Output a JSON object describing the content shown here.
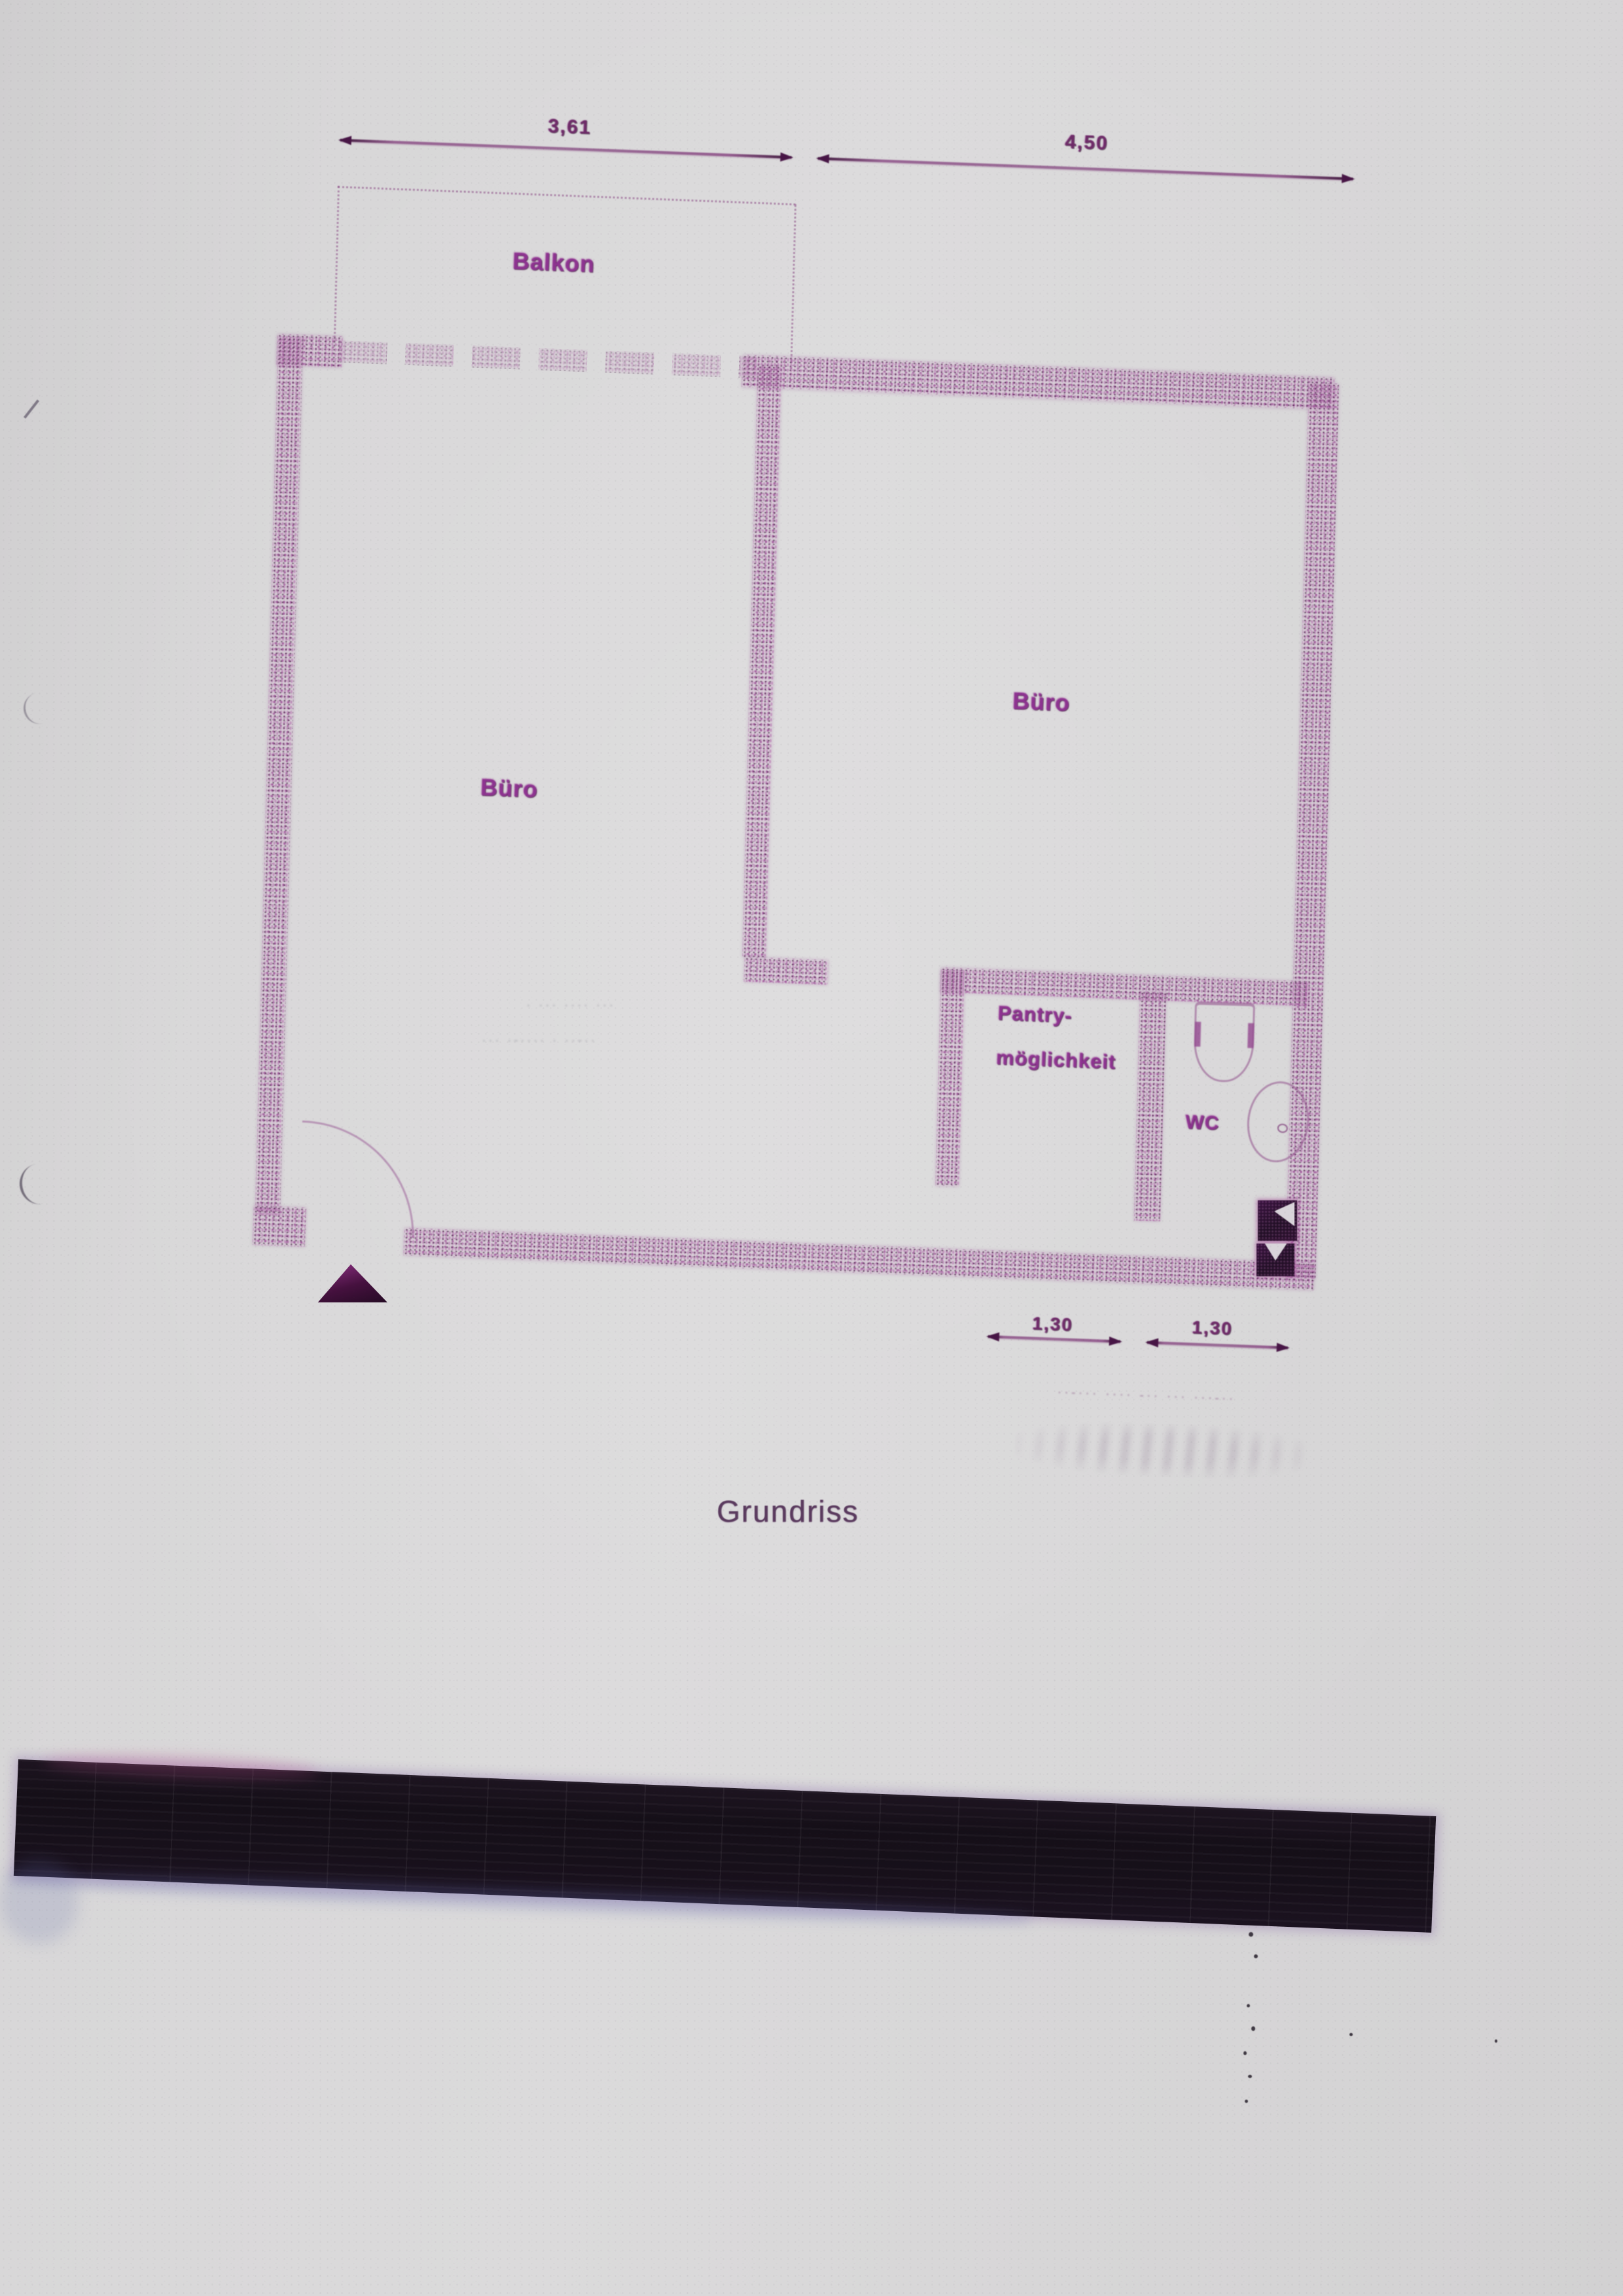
{
  "title": {
    "label": "Grundriss"
  },
  "rooms": {
    "balkon": "Balkon",
    "buero_left": "Büro",
    "buero_right": "Büro",
    "pantry_line1": "Pantry-",
    "pantry_line2": "möglichkeit",
    "wc": "WC"
  },
  "dimensions": {
    "top_left": "3,61",
    "top_right": "4,50",
    "bottom_left": "1,30",
    "bottom_right": "1,30"
  },
  "notes": {
    "room_note_line1": "· ··· ···· ···",
    "room_note_line2": "··· ·-···· · ··-··",
    "script_note": "··-··· ···· -·· ··· ···-··"
  },
  "colors": {
    "paper": "#d7d6d7",
    "wall_magenta": "#9a4a94",
    "label_magenta": "#8d3390",
    "dimension_ink": "#6e2a68",
    "title_ink": "#5a3a5e",
    "redaction_black": "#17101a"
  }
}
